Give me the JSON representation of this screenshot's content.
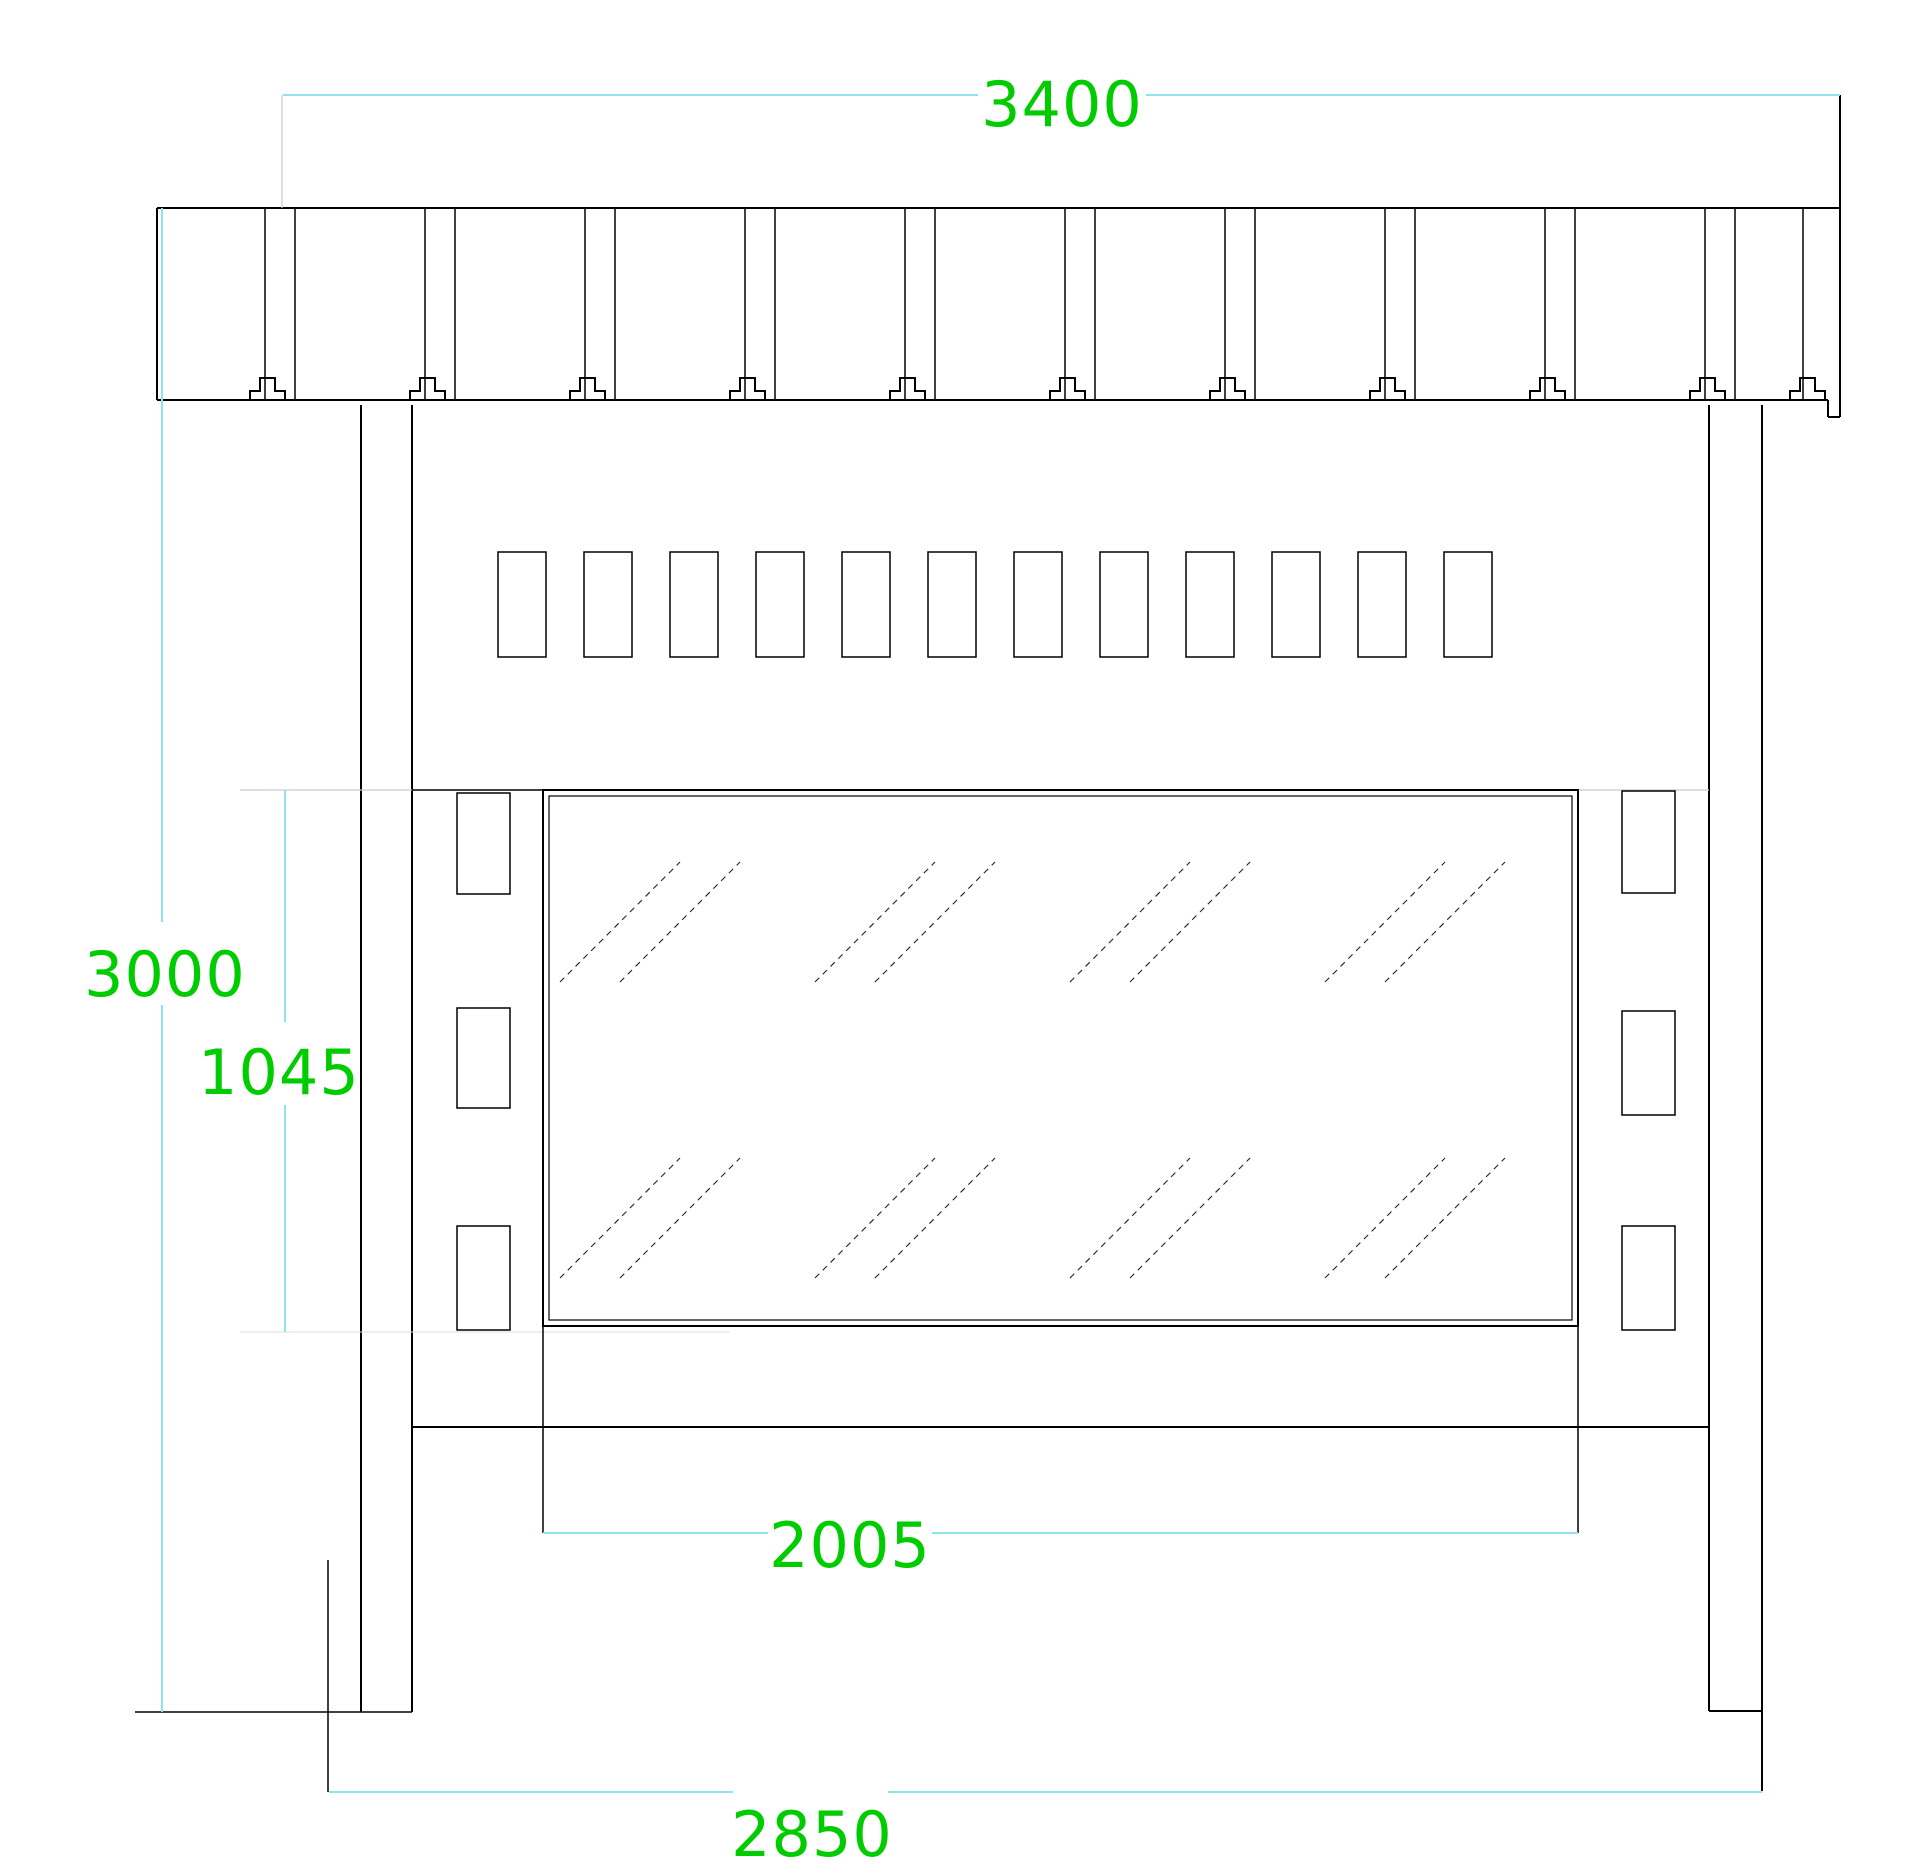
{
  "drawing": {
    "type": "cad-elevation",
    "dimensions": {
      "canopy_width": {
        "value": "3400",
        "orientation": "horizontal",
        "position": "top"
      },
      "overall_height": {
        "value": "3000",
        "orientation": "vertical",
        "position": "left"
      },
      "panel_height": {
        "value": "1045",
        "orientation": "vertical",
        "position": "left-inner"
      },
      "panel_width": {
        "value": "2005",
        "orientation": "horizontal",
        "position": "bottom-middle"
      },
      "base_width": {
        "value": "2850",
        "orientation": "horizontal",
        "position": "bottom"
      }
    },
    "colors": {
      "background": "#ffffff",
      "drawing_line": "#000000",
      "dimension_line": "#8ee4ee",
      "extension_line": "#cccccc",
      "dimension_text": "#00cc00"
    }
  }
}
